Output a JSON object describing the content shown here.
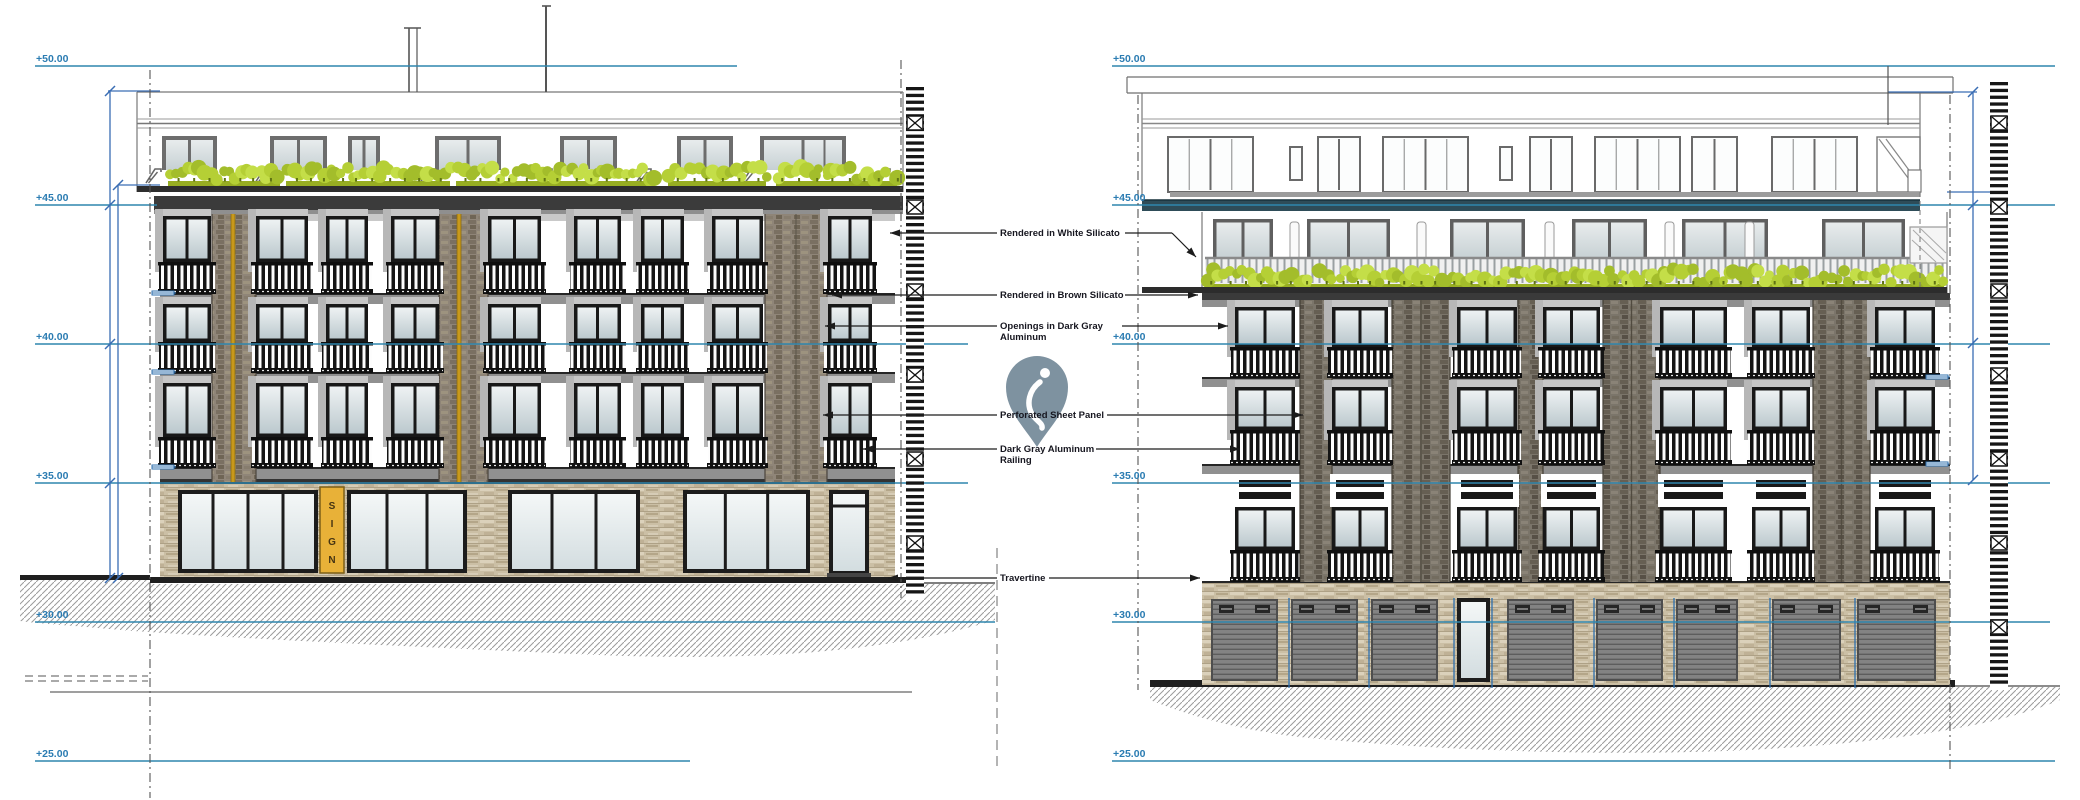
{
  "drawing": {
    "type": "architectural-elevation",
    "views": [
      "front-elevation-left-building",
      "front-elevation-right-building"
    ]
  },
  "elevation_markers": [
    {
      "label": "+50.00"
    },
    {
      "label": "+45.00"
    },
    {
      "label": "+40.00"
    },
    {
      "label": "+35.00"
    },
    {
      "label": "+30.00"
    },
    {
      "label": "+25.00"
    }
  ],
  "annotations": [
    {
      "id": "rendered-white-silicato",
      "lines": [
        "Rendered in White Silicato"
      ]
    },
    {
      "id": "rendered-brown-silicato",
      "lines": [
        "Rendered in Brown Silicato"
      ]
    },
    {
      "id": "openings-dark-gray-aluminum",
      "lines": [
        "Openings in Dark Gray",
        "Aluminum"
      ]
    },
    {
      "id": "perforated-sheet-panel",
      "lines": [
        "Perforated Sheet Panel"
      ]
    },
    {
      "id": "dark-gray-aluminum-railing",
      "lines": [
        "Dark Gray Aluminum",
        "Railing"
      ]
    },
    {
      "id": "travertine",
      "lines": [
        "Travertine"
      ]
    }
  ],
  "storefront_sign": {
    "letters": [
      "S",
      "I",
      "G",
      "N"
    ]
  },
  "icons": {
    "pin": "location-pin-icon"
  },
  "colors": {
    "level_line": "#2f86ad",
    "level_text": "#2b7cb2",
    "dimension": "#3a6db4",
    "leader": "#1c1c1c",
    "annotation_text": "#16161f",
    "pin": "#7e92a0",
    "hedge": "#b5cf35",
    "hedge_dark": "#5f7313",
    "yellow_stripe": "#c8991b",
    "sign_bg": "#e8b138",
    "sign_text": "#463413",
    "brick_left": "#8f8578",
    "brick_right": "#7b756a",
    "travertine": "#cbbfa5",
    "cornice": "#3b3b3b",
    "frame_dark": "#181818",
    "teal_band": "#2e4c58",
    "garage": "#838383",
    "ground": "#1f1f1f",
    "shadow": "#b7b7b7"
  }
}
